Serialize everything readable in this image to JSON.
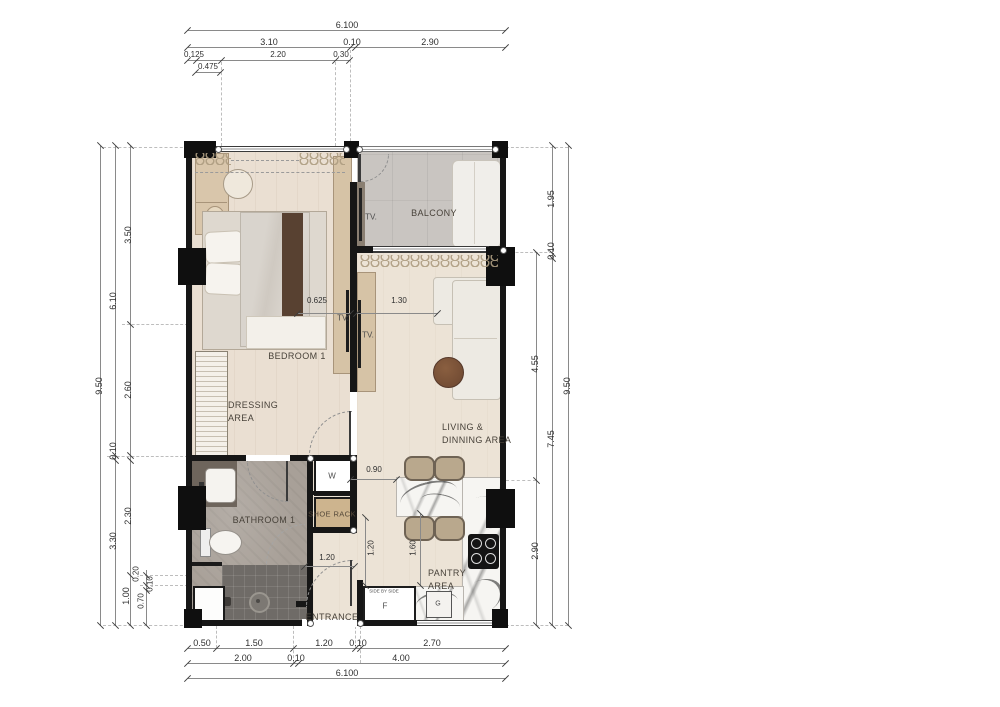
{
  "title": "1-bedroom unit floor plan",
  "colors": {
    "wall": "#161616",
    "wood_floor": "#eadfd2",
    "living_floor": "#ece3d6",
    "balcony_floor": "#c9c5c1",
    "bathroom_floor": "#a8a098",
    "shower_floor": "#6f6b67",
    "wood_furniture": "#d6c3a6",
    "shoe_rack_fill": "#cdb48e",
    "sofa": "#edeae3",
    "coffee_table_wood": "#7a5238",
    "dim_text": "#2f2f2f"
  },
  "labels": {
    "bedroom": "BEDROOM 1",
    "dressing": "DRESSING\nAREA",
    "balcony": "BALCONY",
    "living": "LIVING &\nDINNING AREA",
    "bathroom": "BATHROOM 1",
    "entrance": "ENTRANCE",
    "pantry": "PANTRY\nAREA",
    "shoe_rack": "SHOE RACK",
    "washer": "W",
    "fridge": "F",
    "fridge_note": "SIDE BY SIDE",
    "stove": "G",
    "tv": "TV."
  },
  "dims": {
    "top_total": "6.100",
    "top_310": "3.10",
    "top_010": "0.10",
    "top_290": "2.90",
    "top_0125": "0.125",
    "top_0475": "0.475",
    "top_220": "2.20",
    "top_030": "0.30",
    "left_950": "9.50",
    "left_610": "6.10",
    "left_010a": "0.10",
    "left_330": "3.30",
    "left_350": "3.50",
    "left_260": "2.60",
    "left_230": "2.30",
    "left_100": "1.00",
    "left_020": "0.20",
    "left_010b": "0.10",
    "left_070": "0.70",
    "right_950": "9.50",
    "right_195": "1.95",
    "right_010": "0.10",
    "right_745": "7.45",
    "right_455": "4.55",
    "right_290": "2.90",
    "bot_050": "0.50",
    "bot_150": "1.50",
    "bot_120": "1.20",
    "bot_010a": "0.10",
    "bot_270": "2.70",
    "bot_200": "2.00",
    "bot_010b": "0.10",
    "bot_400": "4.00",
    "bot_total": "6.100",
    "in_0625": "0.625",
    "in_130": "1.30",
    "in_090": "0.90",
    "in_120v": "1.20",
    "in_160": "1.60",
    "in_120h": "1.20"
  }
}
